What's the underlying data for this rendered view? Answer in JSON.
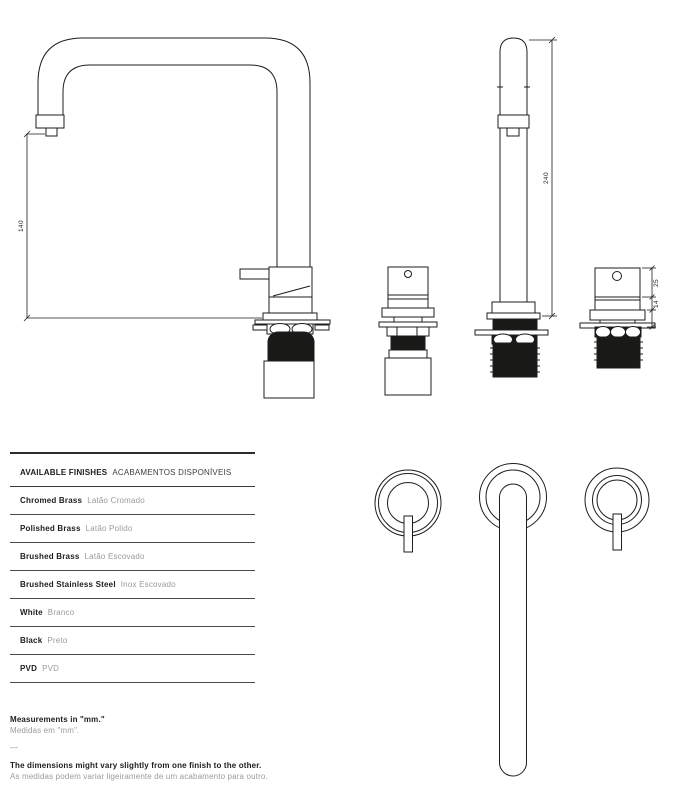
{
  "drawing": {
    "dimensions": {
      "spout_height": "140",
      "total_height": "240",
      "handle_body_height": "25",
      "handle_base_height": "14"
    }
  },
  "finishes": {
    "title_en": "AVAILABLE FINISHES",
    "title_pt": "ACABAMENTOS DISPONÍVEIS",
    "rows": [
      {
        "en": "Chromed Brass",
        "pt": "Latão Cromado"
      },
      {
        "en": "Polished Brass",
        "pt": "Latão Polido"
      },
      {
        "en": "Brushed Brass",
        "pt": "Latão Escovado"
      },
      {
        "en": "Brushed Stainless Steel",
        "pt": "Inox Escovado"
      },
      {
        "en": "White",
        "pt": "Branco"
      },
      {
        "en": "Black",
        "pt": "Preto"
      },
      {
        "en": "PVD",
        "pt": "PVD"
      }
    ]
  },
  "notes": {
    "measurements_en": "Measurements in \"mm.\"",
    "measurements_pt": "Medidas em \"mm\".",
    "separator": "—",
    "tolerance_en": "The dimensions might vary slightly from one finish to the other.",
    "tolerance_pt": "As medidas podem variar ligeiramente de um acabamento para outro."
  },
  "colors": {
    "line": "#1d1d1b",
    "fill_black": "#191917",
    "text_secondary": "#9b9b9b"
  }
}
